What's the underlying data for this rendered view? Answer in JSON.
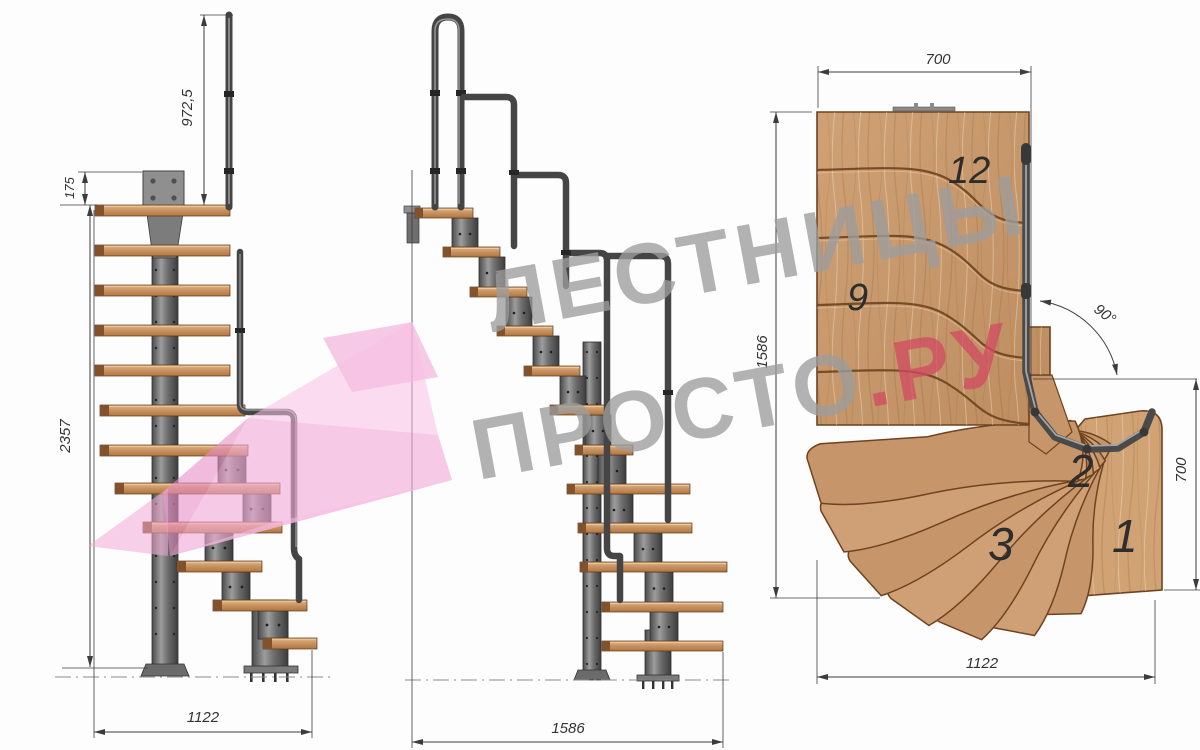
{
  "watermark": {
    "line1": "ЛЕСТНИЦЫ",
    "line2": "ПРОСТО",
    "suffix": ".РУ",
    "text_color": "#9d9d9d",
    "suffix_color": "#d14a62",
    "arrow_color": "#f2a9d6"
  },
  "views": {
    "side_elevation": {
      "dimensions": {
        "handrail_height": "972,5",
        "top_plate": "175",
        "total_height": "2357",
        "run": "1122"
      }
    },
    "front_elevation": {
      "dimensions": {
        "run": "1586"
      }
    },
    "plan": {
      "dimensions": {
        "top_width": "700",
        "depth": "1586",
        "turn_angle": "90°",
        "right_depth": "700",
        "bottom_width": "1122"
      },
      "step_labels": {
        "s12": "12",
        "s9": "9",
        "s3": "3",
        "s2": "2",
        "s1": "1"
      }
    }
  },
  "colors": {
    "wood_light": "#d8ad80",
    "wood_dark": "#b97f4e",
    "metal_dark": "#454545",
    "dimension_line": "#3c3c3c"
  }
}
